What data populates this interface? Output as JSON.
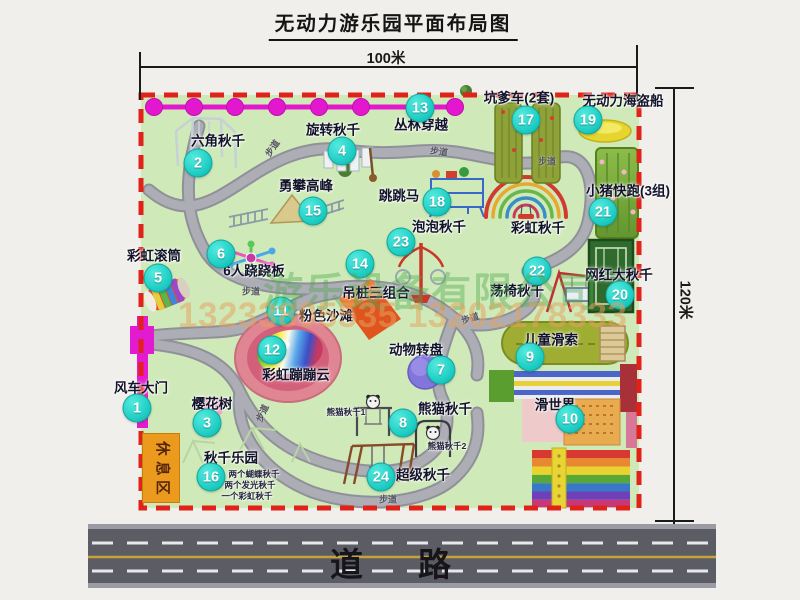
{
  "title": "无动力游乐园平面布局图",
  "dimensions": {
    "width": "100米",
    "height": "120米"
  },
  "road": {
    "label": "道路"
  },
  "watermark": {
    "company": "游乐设备有限公司",
    "phone": "13233805535 13202178333"
  },
  "map": {
    "rest_area_label": "休息区",
    "walkway_label": "步道",
    "walkway_positions": [
      {
        "x": 272,
        "y": 148,
        "r": -55
      },
      {
        "x": 439,
        "y": 151,
        "r": 8
      },
      {
        "x": 547,
        "y": 161,
        "r": 0
      },
      {
        "x": 251,
        "y": 291,
        "r": 0
      },
      {
        "x": 470,
        "y": 318,
        "r": -18
      },
      {
        "x": 262,
        "y": 413,
        "r": -65
      },
      {
        "x": 388,
        "y": 499,
        "r": 0
      }
    ],
    "attractions": [
      {
        "num": "1",
        "name": "风车大门",
        "bx": 137,
        "by": 408,
        "lx": 141,
        "ly": 388
      },
      {
        "num": "2",
        "name": "六角秋千",
        "bx": 198,
        "by": 163,
        "lx": 218,
        "ly": 141
      },
      {
        "num": "3",
        "name": "樱花树",
        "bx": 207,
        "by": 423,
        "lx": 212,
        "ly": 404
      },
      {
        "num": "4",
        "name": "旋转秋千",
        "bx": 342,
        "by": 151,
        "lx": 333,
        "ly": 130
      },
      {
        "num": "5",
        "name": "彩虹滚筒",
        "bx": 158,
        "by": 278,
        "lx": 154,
        "ly": 256
      },
      {
        "num": "6",
        "name": "6人跷跷板",
        "bx": 221,
        "by": 254,
        "lx": 254,
        "ly": 271
      },
      {
        "num": "7",
        "name": "动物转盘",
        "bx": 441,
        "by": 370,
        "lx": 416,
        "ly": 350
      },
      {
        "num": "8",
        "name": "熊猫秋千",
        "bx": 403,
        "by": 423,
        "lx": 445,
        "ly": 409
      },
      {
        "num": "9",
        "name": "儿童滑索",
        "bx": 530,
        "by": 357,
        "lx": 551,
        "ly": 340
      },
      {
        "num": "10",
        "name": "滑世界",
        "bx": 570,
        "by": 419,
        "lx": 555,
        "ly": 405
      },
      {
        "num": "11",
        "name": "粉色沙滩",
        "bx": 281,
        "by": 311,
        "lx": 326,
        "ly": 316
      },
      {
        "num": "12",
        "name": "彩虹蹦蹦云",
        "bx": 272,
        "by": 350,
        "lx": 296,
        "ly": 375
      },
      {
        "num": "13",
        "name": "丛林穿越",
        "bx": 420,
        "by": 108,
        "lx": 421,
        "ly": 125
      },
      {
        "num": "14",
        "name": "吊桩三组合",
        "bx": 360,
        "by": 264,
        "lx": 376,
        "ly": 293
      },
      {
        "num": "15",
        "name": "勇攀高峰",
        "bx": 313,
        "by": 211,
        "lx": 306,
        "ly": 186
      },
      {
        "num": "16",
        "name": "秋千乐园",
        "bx": 211,
        "by": 477,
        "lx": 231,
        "ly": 458
      },
      {
        "num": "17",
        "name": "坑爹车(2套)",
        "bx": 526,
        "by": 120,
        "lx": 519,
        "ly": 98
      },
      {
        "num": "18",
        "name": "跳跳马",
        "bx": 437,
        "by": 202,
        "lx": 399,
        "ly": 196
      },
      {
        "num": "19",
        "name": "无动力海盗船",
        "bx": 588,
        "by": 120,
        "lx": 623,
        "ly": 101
      },
      {
        "num": "20",
        "name": "网红大秋千",
        "bx": 620,
        "by": 295,
        "lx": 619,
        "ly": 275
      },
      {
        "num": "21",
        "name": "小猪快跑(3组)",
        "bx": 603,
        "by": 212,
        "lx": 628,
        "ly": 191
      },
      {
        "num": "22",
        "name": "荡椅秋千",
        "bx": 537,
        "by": 271,
        "lx": 517,
        "ly": 291
      },
      {
        "num": "23",
        "name": "泡泡秋千",
        "bx": 401,
        "by": 242,
        "lx": 439,
        "ly": 227
      },
      {
        "num": "24",
        "name": "超级秋千",
        "bx": 381,
        "by": 477,
        "lx": 423,
        "ly": 475
      }
    ],
    "extra_labels": [
      {
        "text": "彩虹秋千",
        "x": 538,
        "y": 228,
        "cls": ""
      },
      {
        "text": "熊猫秋千1",
        "x": 346,
        "y": 412,
        "cls": "small"
      },
      {
        "text": "熊猫秋千2",
        "x": 447,
        "y": 446,
        "cls": "small"
      },
      {
        "text": "两个蝴蝶秋千",
        "x": 254,
        "y": 474,
        "cls": "small"
      },
      {
        "text": "两个发光秋千",
        "x": 250,
        "y": 485,
        "cls": "small"
      },
      {
        "text": "一个彩虹秋千",
        "x": 247,
        "y": 496,
        "cls": "small"
      }
    ]
  }
}
